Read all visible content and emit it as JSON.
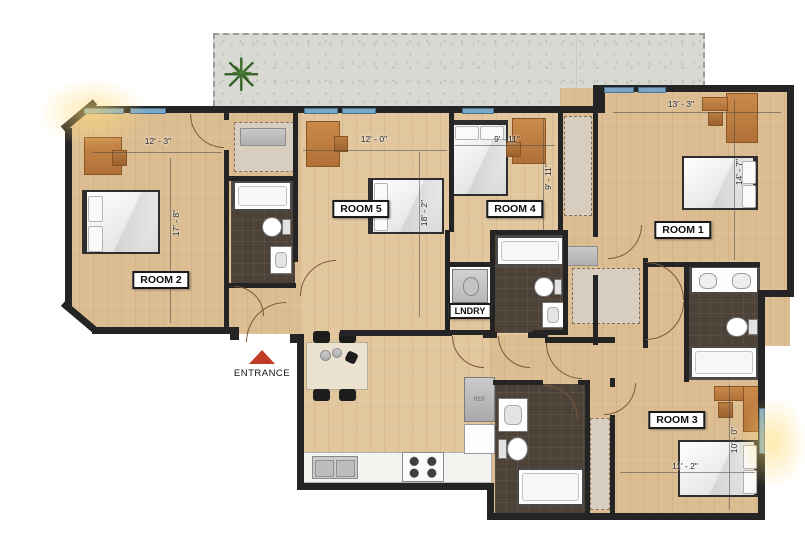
{
  "floorplan": {
    "title": "5-bedroom unit floor plan",
    "rooms": {
      "room1": {
        "label": "ROOM 1",
        "width_dim": "13' - 3\"",
        "height_dim": "14' - 7\""
      },
      "room2": {
        "label": "ROOM 2",
        "width_dim": "12' - 3\"",
        "height_dim": "17' - 8\""
      },
      "room3": {
        "label": "ROOM 3",
        "width_dim": "11' - 2\"",
        "height_dim": "10' - 0\""
      },
      "room4": {
        "label": "ROOM 4",
        "width_dim": "9' - 11\"",
        "height_dim": "9' - 11\""
      },
      "room5": {
        "label": "ROOM 5",
        "width_dim": "12' - 0\"",
        "height_dim": "18' - 2\""
      }
    },
    "laundry_label": "LNDRY",
    "entrance_label": "ENTRANCE",
    "fridge_label": "REF",
    "colors": {
      "wall": "#242424",
      "wood": "#dcbd92",
      "tile": "#4d4237",
      "window": "#7aa7c7",
      "concrete": "#d9d9d4",
      "accent_red": "#c23b27"
    }
  }
}
